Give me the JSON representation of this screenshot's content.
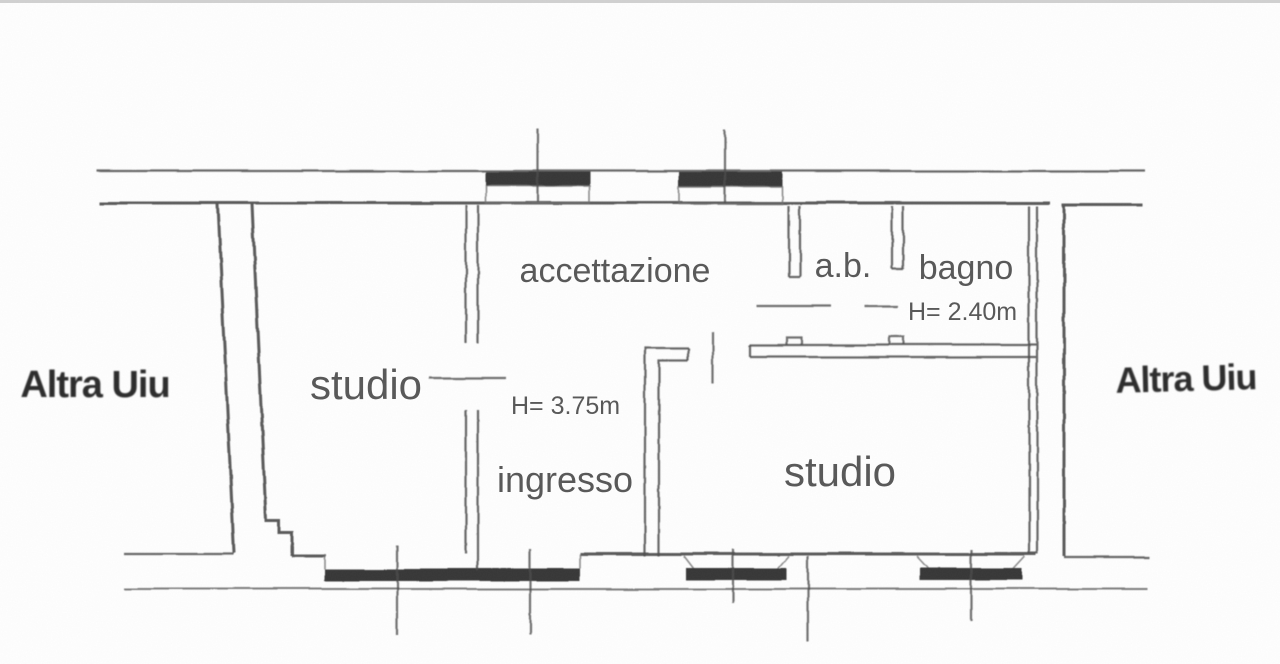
{
  "window_chrome": {
    "top_border_color": "#d2d2d2"
  },
  "floor_plan": {
    "labels": {
      "accettazione": "accettazione",
      "ab": "a.b.",
      "bagno": "bagno",
      "bagno_height": "H= 2.40m",
      "studio_left": "studio",
      "main_height": "H= 3.75m",
      "ingresso": "ingresso",
      "studio_right": "studio",
      "neighbor_left": "Altra Uiu",
      "neighbor_right": "Altra Uiu"
    },
    "colors": {
      "wall_stroke": "#4c4c4c",
      "thin_stroke": "#707070",
      "window_fill": "#2a2a2a",
      "room_label": "#585858",
      "neighbor_label": "#2b2b2b",
      "background": "#ffffff"
    }
  }
}
